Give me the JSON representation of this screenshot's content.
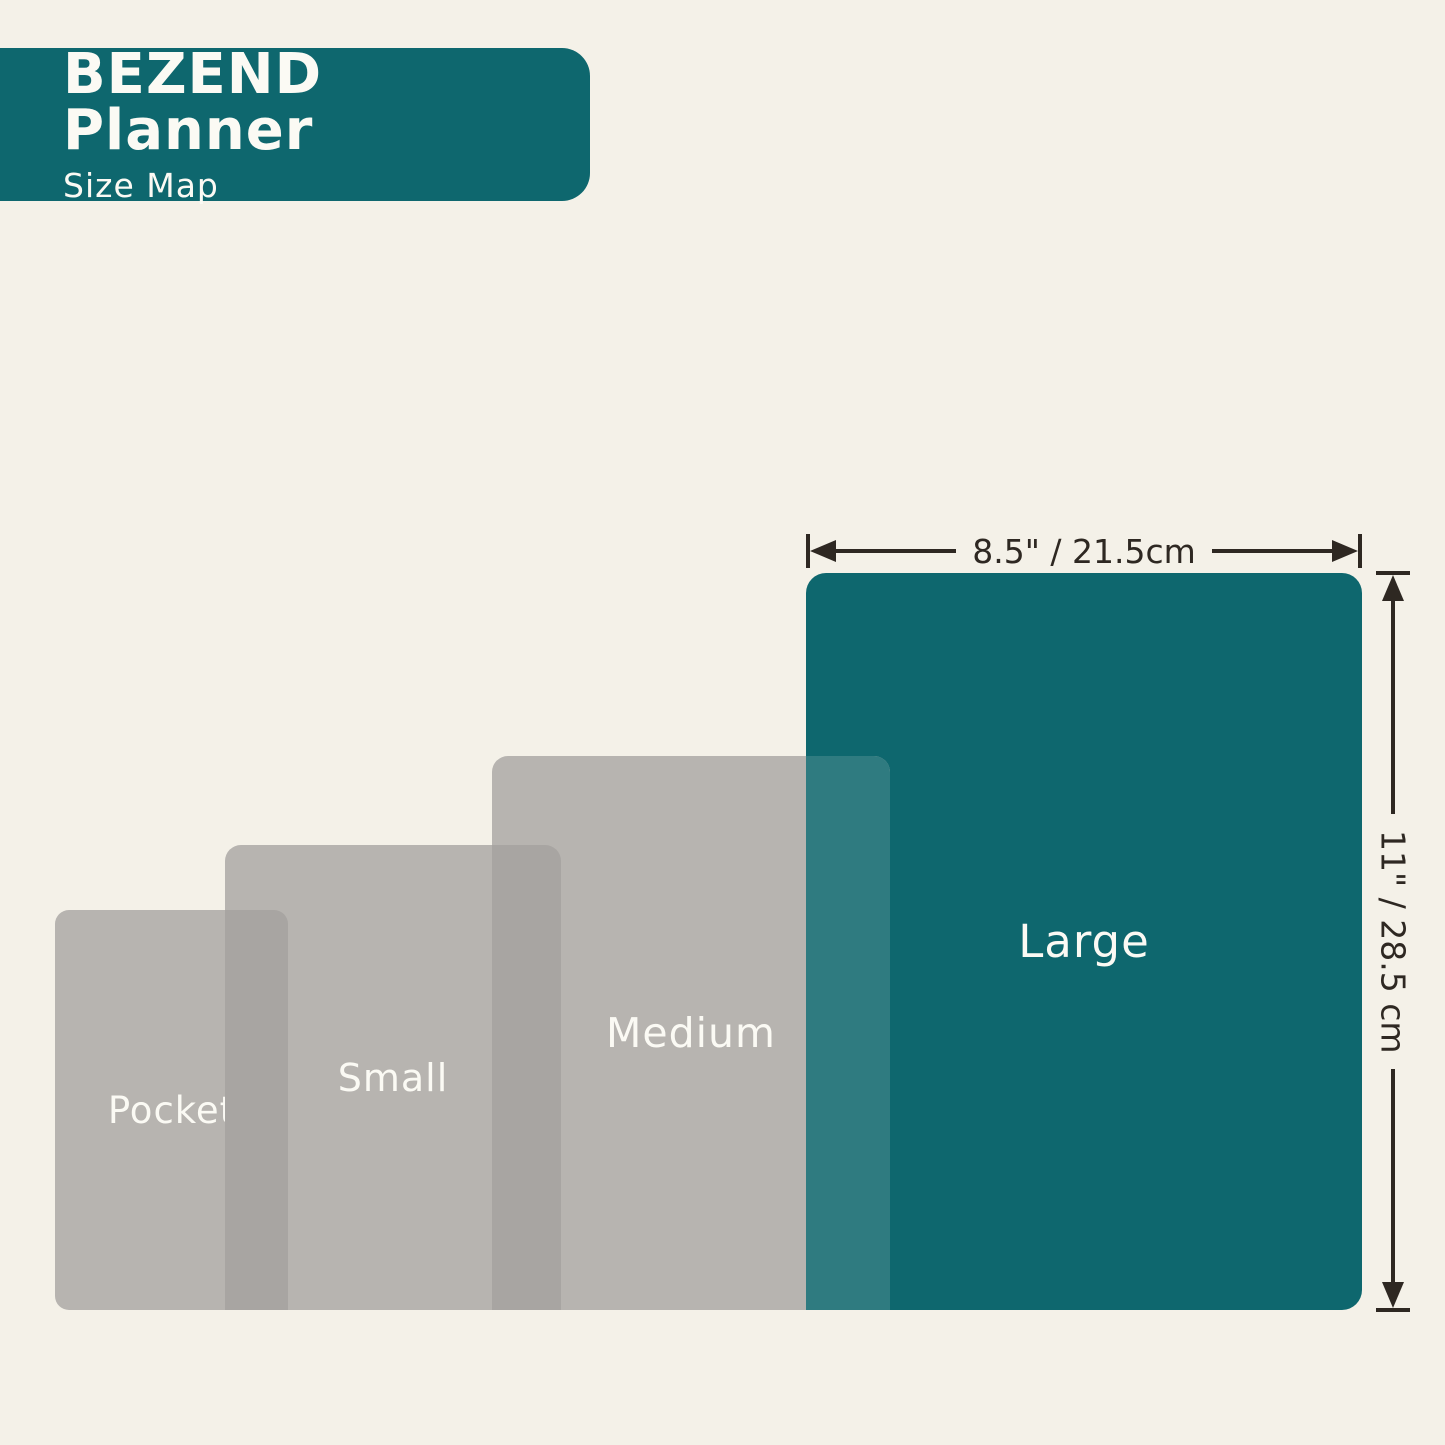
{
  "header": {
    "title": "BEZEND Planner",
    "subtitle": "Size Map"
  },
  "sizes": [
    {
      "id": "pocket",
      "label": "Pocket"
    },
    {
      "id": "small",
      "label": "Small"
    },
    {
      "id": "medium",
      "label": "Medium"
    },
    {
      "id": "large",
      "label": "Large"
    }
  ],
  "dimensions": {
    "width_label": "8.5\" / 21.5cm",
    "height_label": "11\" / 28.5 cm"
  },
  "colors": {
    "background": "#f4f1e8",
    "teal": "#0e676e",
    "gray": "#b7b4b0",
    "gray_overlap": "#a8a5a2",
    "teal_overlap": "#2f7b80",
    "dim_line": "#2e2822",
    "label_text": "#fbfaf4"
  }
}
